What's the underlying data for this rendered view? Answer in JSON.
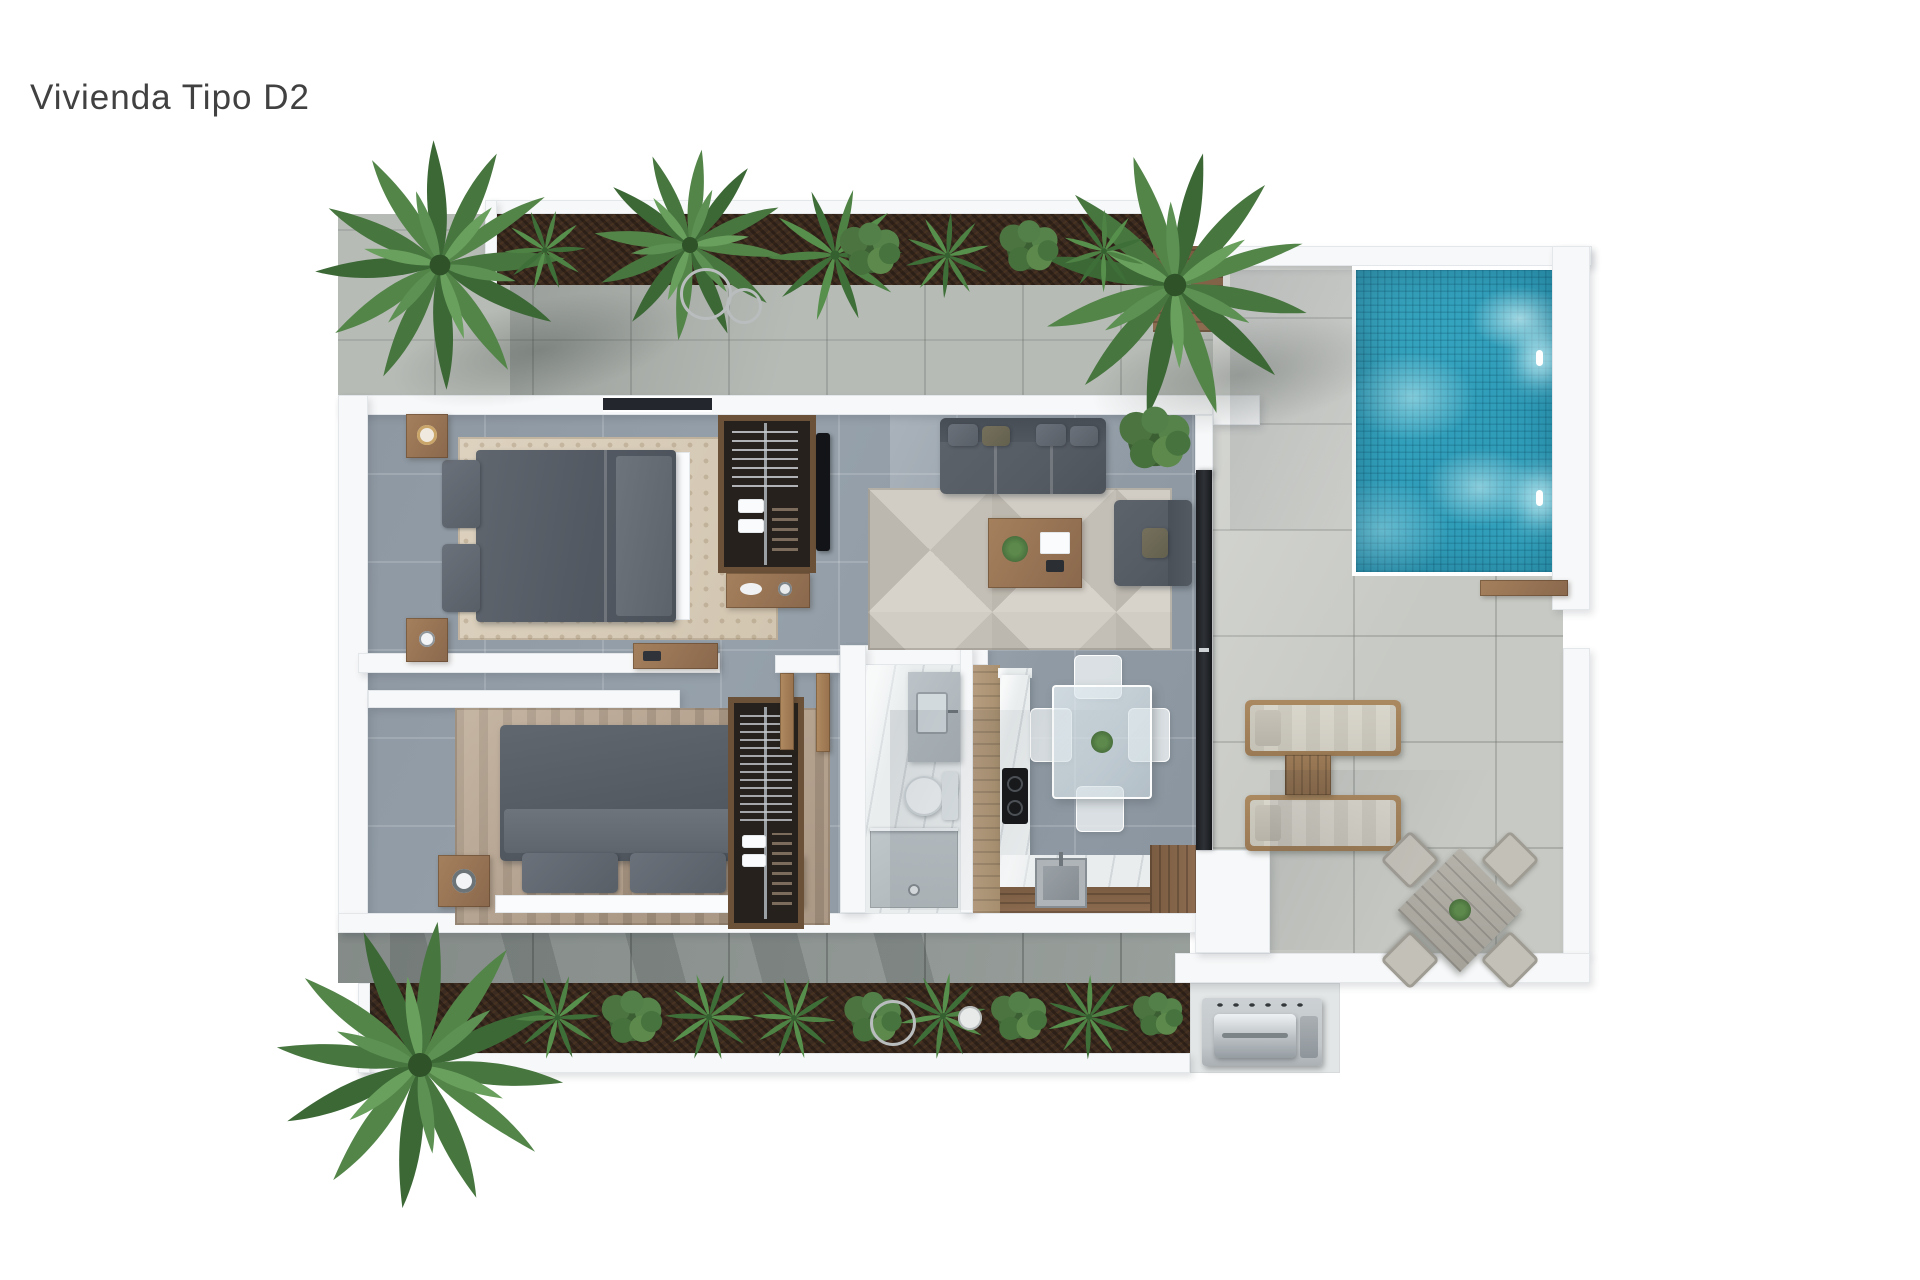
{
  "title": "Vivienda Tipo D2",
  "colors": {
    "background": "#ffffff",
    "title_text": "#414141",
    "wall": "#f7f8f9",
    "wall_edge": "#e4e7ea",
    "tile_indoor": "#95a0aa",
    "tile_terrace": "#c7c9c4",
    "tile_walkway": "#b7bbb6",
    "tile_walkway_dark": "#8f9693",
    "pool_water": "#2f9cb8",
    "pool_light": "#d8f4f8",
    "planter_soil": "#3b2b20",
    "plant_green": "#47763f",
    "plant_green_light": "#5d9153",
    "wood": "#8a684c",
    "wood_deck": "#7a5c42",
    "fabric_dark": "#565c64",
    "cushion_light": "#d9d6cc",
    "marble": "#e9edee",
    "steel": "#c2c7ca",
    "glass": "#dfe9ec"
  },
  "areas": [
    "top-garden-planter",
    "entry-walkway",
    "outdoor-shower-deck",
    "swimming-pool",
    "pool-terrace",
    "bedroom-1",
    "wardrobe-bedroom-1",
    "hallway",
    "bedroom-2",
    "wardrobe-bedroom-2",
    "bathroom",
    "kitchen",
    "dining-area",
    "living-room",
    "sun-lounger-area",
    "outdoor-dining-area",
    "bbq-area",
    "bottom-garden-planter"
  ]
}
